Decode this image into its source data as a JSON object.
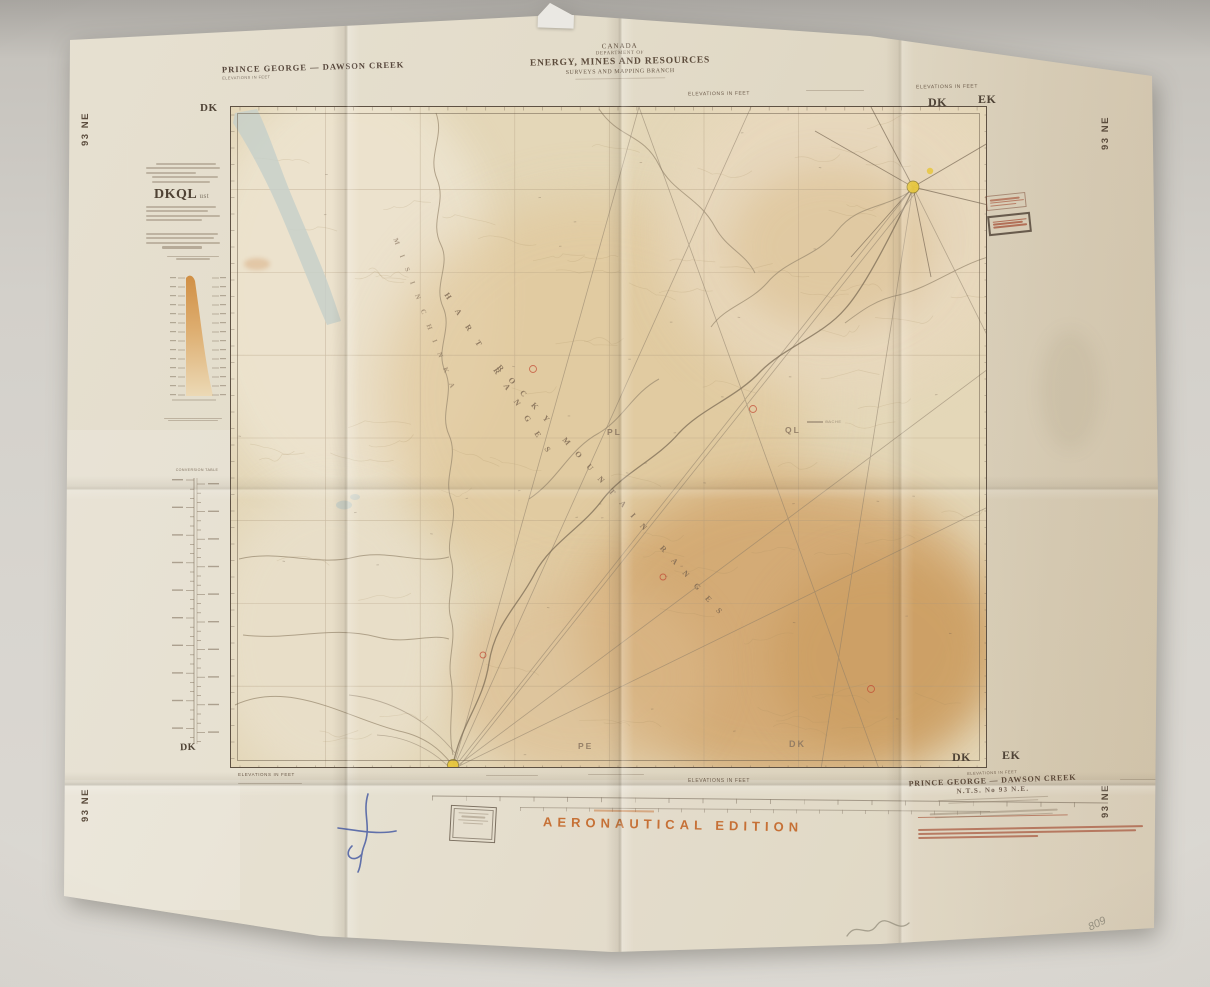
{
  "photo": {
    "pencil_note": "809",
    "accent_orange": "#c4682a",
    "paper_color": "#e3dcca",
    "surface_color": "#cfccc6"
  },
  "header": {
    "country": "CANADA",
    "department_of": "DEPARTMENT OF",
    "department_name": "ENERGY, MINES AND RESOURCES",
    "branch": "SURVEYS AND MAPPING BRANCH",
    "series_title": "PRINCE GEORGE — DAWSON CREEK",
    "elevations_note": "ELEVATIONS IN FEET"
  },
  "sheet_codes": {
    "left": "DK",
    "right": "EK",
    "number": "93 NE",
    "panel_code": "DKQL"
  },
  "side_panel": {
    "conversion_table_title": "CONVERSION TABLE"
  },
  "map_labels": {
    "ranges": [
      {
        "text": "MISINCHINKA"
      },
      {
        "text": "HART RANGES"
      },
      {
        "text": "ROCKY MOUNTAIN RANGES"
      }
    ],
    "blocks": [
      {
        "text": "PL"
      },
      {
        "text": "QL"
      },
      {
        "text": "PE"
      },
      {
        "text": "DK"
      }
    ],
    "cache": "CACHE"
  },
  "footer": {
    "elevations_note": "ELEVATIONS IN FEET",
    "edition": "AERONAUTICAL EDITION",
    "sheet_title": "PRINCE GEORGE — DAWSON CREEK",
    "nts_number": "N.T.S. No 93 N.E."
  }
}
